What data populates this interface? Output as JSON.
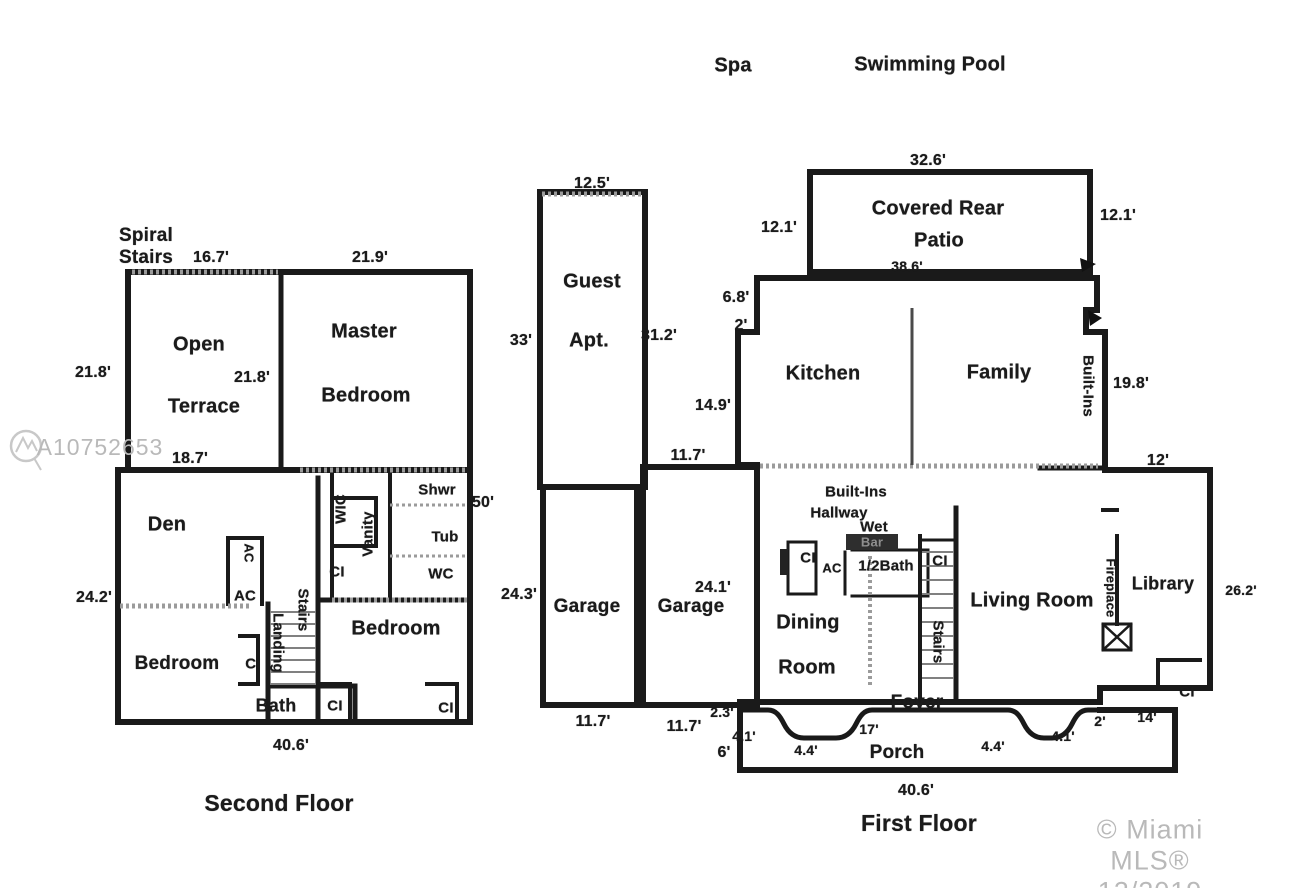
{
  "site": {
    "spa": "Spa",
    "pool": "Swimming Pool"
  },
  "watermarks": {
    "photo_id": "A10752653",
    "copyright": "© Miami MLS® 12/2019"
  },
  "second_floor": {
    "title": "Second Floor",
    "rooms": {
      "spiral_stairs": "Spiral\nStairs",
      "open": "Open",
      "terrace": "Terrace",
      "master1": "Master",
      "master2": "Bedroom",
      "den": "Den",
      "wic": "WIC",
      "vanity": "Vanity",
      "shwr": "Shwr",
      "tub": "Tub",
      "wc": "WC",
      "stairs": "Stairs",
      "landing": "Landing",
      "bedroom_left": "Bedroom",
      "bedroom_right": "Bedroom",
      "bath": "Bath",
      "ac_upper": "AC",
      "ac_lower": "AC",
      "ci_hall": "CI",
      "ci_bedroom": "CI",
      "ci_bath": "CI",
      "ci_right": "CI"
    },
    "dims": {
      "top_left": "16.7'",
      "top_right": "21.9'",
      "terrace_left": "21.8'",
      "terrace_inner": "21.8'",
      "terrace_bottom": "18.7'",
      "right_side": "50'",
      "left_side": "24.2'",
      "bottom": "40.6'"
    }
  },
  "guest_wing": {
    "rooms": {
      "guest": "Guest",
      "apt": "Apt.",
      "garage_left": "Garage",
      "garage_right": "Garage"
    },
    "dims": {
      "guest_top": "12.5'",
      "guest_left": "33'",
      "guest_right": "31.2'",
      "garage_left_side": "24.3'",
      "garage_left_bottom": "11.7'",
      "garage_right_width": "24.1'",
      "garage_right_top": "11.7'",
      "garage_right_bottom": "11.7'",
      "step": "2.3'",
      "porch_left": "6'"
    }
  },
  "first_floor": {
    "title": "First Floor",
    "rooms": {
      "patio1": "Covered Rear",
      "patio2": "Patio",
      "kitchen": "Kitchen",
      "family": "Family",
      "built_ins_wall": "Built-Ins",
      "hallway1": "Built-Ins",
      "hallway2": "Hallway",
      "wet": "Wet",
      "bar": "Bar",
      "half_bath": "1/2Bath",
      "ac": "AC",
      "dining1": "Dining",
      "dining2": "Room",
      "stairs": "Stairs",
      "living": "Living Room",
      "fireplace": "Fireplace",
      "library": "Library",
      "foyer": "Foyer",
      "porch": "Porch",
      "ci_hall": "CI",
      "ci_stairs": "CI",
      "ci_library": "CI"
    },
    "dims": {
      "patio_top": "32.6'",
      "patio_left": "12.1'",
      "patio_right": "12.1'",
      "patio_bottom": "38.6'",
      "step_a": "6.8'",
      "step_b": "2'",
      "kitchen_left": "14.9'",
      "family_right": "19.8'",
      "library_top": "12'",
      "library_right": "26.2'",
      "library_bottom": "14'",
      "porch_17": "17'",
      "porch_41_left": "4.1'",
      "porch_44_left": "4.4'",
      "porch_44_right": "4.4'",
      "porch_41_right": "4.1'",
      "porch_2": "2'",
      "bottom": "40.6'"
    }
  }
}
